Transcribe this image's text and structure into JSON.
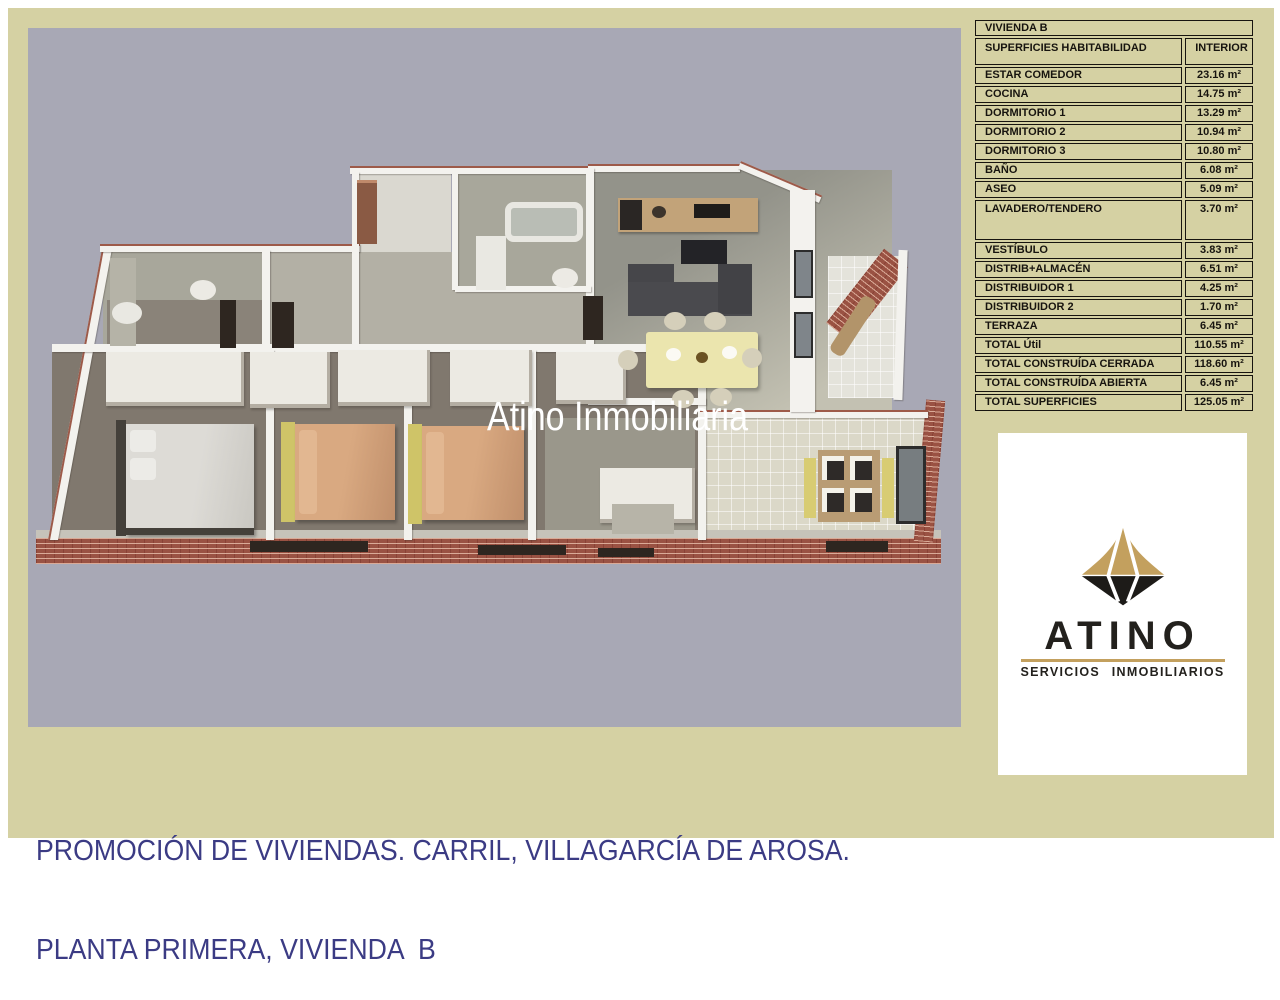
{
  "page": {
    "watermark": "Atino Inmobiliaria",
    "caption_line1": "PROMOCIÓN DE VIVIENDAS. CARRIL, VILLAGARCÍA DE AROSA.",
    "caption_line2": "PLANTA PRIMERA, VIVIENDA  B"
  },
  "surfaces_table": {
    "title": "VIVIENDA B",
    "col_label": "SUPERFICIES HABITABILIDAD",
    "col_value": "INTERIOR",
    "rows": [
      {
        "label": "ESTAR COMEDOR",
        "value": "23.16 m²"
      },
      {
        "label": "COCINA",
        "value": "14.75 m²"
      },
      {
        "label": "DORMITORIO 1",
        "value": "13.29 m²"
      },
      {
        "label": "DORMITORIO 2",
        "value": "10.94 m²"
      },
      {
        "label": "DORMITORIO 3",
        "value": "10.80 m²"
      },
      {
        "label": "BAÑO",
        "value": "6.08 m²"
      },
      {
        "label": "ASEO",
        "value": "5.09 m²"
      },
      {
        "label": "LAVADERO/TENDERO",
        "value": "3.70 m²"
      },
      {
        "label": "VESTÍBULO",
        "value": "3.83 m²"
      },
      {
        "label": "DISTRIB+ALMACÉN",
        "value": "6.51 m²"
      },
      {
        "label": "DISTRIBUIDOR 1",
        "value": "4.25 m²"
      },
      {
        "label": "DISTRIBUIDOR 2",
        "value": "1.70 m²"
      },
      {
        "label": "TERRAZA",
        "value": "6.45 m²"
      },
      {
        "label": "TOTAL Útil",
        "value": "110.55 m²"
      },
      {
        "label": "TOTAL CONSTRUÍDA CERRADA",
        "value": "118.60 m²"
      },
      {
        "label": "TOTAL CONSTRUÍDA ABIERTA",
        "value": "6.45 m²"
      },
      {
        "label": "TOTAL SUPERFICIES",
        "value": "125.05 m²"
      }
    ]
  },
  "logo": {
    "brand": "ATINO",
    "tagline": "SERVICIOS  INMOBILIARIOS"
  },
  "colors": {
    "frame_khaki": "#d5d1a3",
    "plan_background": "#a8a8b5",
    "caption_text": "#3b3b84",
    "brick_wall": "#9a5243",
    "logo_gold": "#c3a05e",
    "bed_salmon": "#cf9c79",
    "dining_table_yellow": "#ebe5ae"
  }
}
